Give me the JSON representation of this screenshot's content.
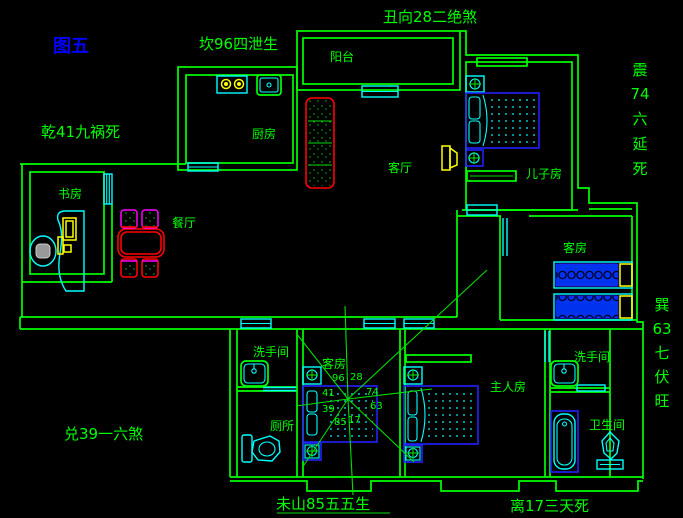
{
  "figure_title": "图五",
  "annotations": {
    "top": "丑向28二绝煞",
    "north": "坎96四泄生",
    "northwest": "乾41九祸死",
    "west": "兑39一六煞",
    "south_mountain": "未山85五五生",
    "south": "离17三天死",
    "east_full": "震74六延死",
    "east_chars": [
      "震",
      "74",
      "六",
      "延",
      "死"
    ],
    "southeast_full": "巽63七伏旺",
    "southeast_chars": [
      "巽",
      "63",
      "七",
      "伏",
      "旺"
    ]
  },
  "rooms": {
    "balcony": "阳台",
    "kitchen": "厨房",
    "living_room": "客厅",
    "sons_room": "儿子房",
    "study": "书房",
    "dining_room": "餐厅",
    "guest_room_right": "客房",
    "guest_room_middle": "客房",
    "washroom_left": "洗手间",
    "toilet_room": "厕所",
    "master_bedroom": "主人房",
    "washroom_right": "洗手间",
    "bathroom": "卫生间"
  },
  "compass": {
    "numbers": {
      "upper_left": "96",
      "upper_right": "28",
      "left_upper": "41",
      "right_upper": "74",
      "left_lower": "39",
      "right_lower": "63",
      "lower_left": "85",
      "lower_right": "17"
    }
  },
  "colors": {
    "background": "#000000",
    "wall_green": "#00ff00",
    "fixture_cyan": "#00ffff",
    "furniture_blue": "#2222ff",
    "accent_red": "#ff0000",
    "accent_magenta": "#ff00ff",
    "accent_yellow": "#ffff00",
    "title_blue": "#0000ff"
  }
}
